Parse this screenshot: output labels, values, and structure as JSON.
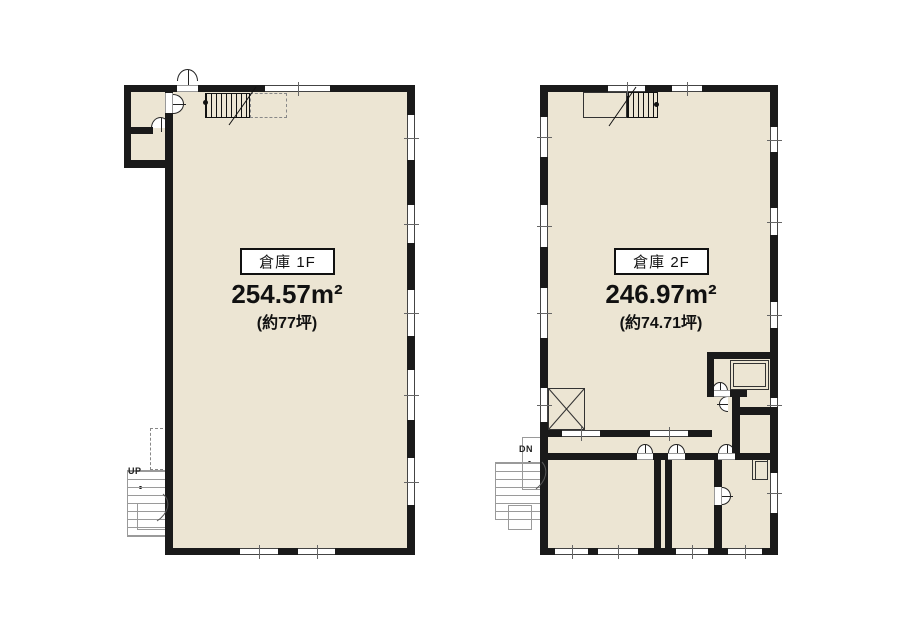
{
  "floor1": {
    "name_label": "倉庫 1F",
    "area_m2": "254.57m²",
    "area_tsubo": "(約77坪)",
    "exterior_stair_label": "UP"
  },
  "floor2": {
    "name_label": "倉庫 2F",
    "area_m2": "246.97m²",
    "area_tsubo": "(約74.71坪)",
    "exterior_stair_label": "DN"
  },
  "colors": {
    "floor_fill": "#ECE5D3",
    "wall": "#1A1A1A",
    "background": "#FFFFFF",
    "stair_gray": "#9A9A9A"
  }
}
